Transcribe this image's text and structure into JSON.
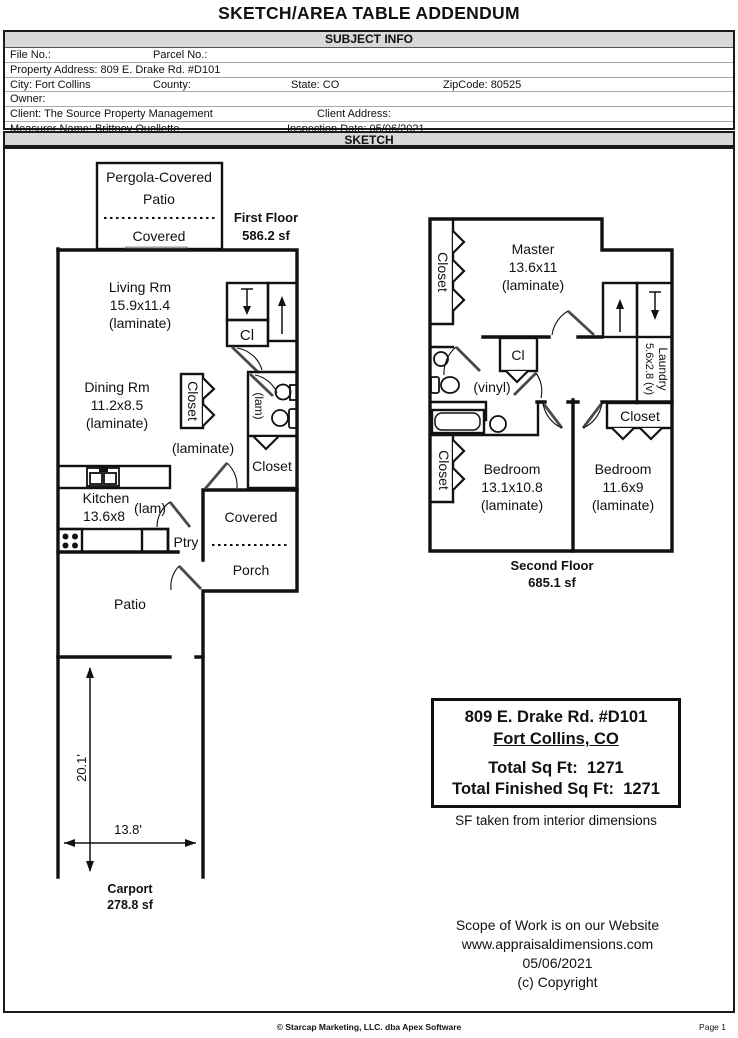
{
  "page": {
    "title": "SKETCH/AREA TABLE ADDENDUM",
    "footer_center": "© Starcap Marketing, LLC. dba Apex Software",
    "footer_right": "Page 1"
  },
  "colors": {
    "bar_gray": "#d8d8d8",
    "wall_black": "#111111"
  },
  "subject_info": {
    "section_title": "SUBJECT INFO",
    "file_no": "File No.:",
    "parcel_no": "Parcel No.:",
    "property_address": "Property Address: 809 E. Drake Rd. #D101",
    "city": "City: Fort Collins",
    "county": "County:",
    "state": "State: CO",
    "zipcode": "ZipCode: 80525",
    "owner": "Owner:",
    "client": "Client: The Source Property Management",
    "client_address": "Client Address:",
    "measurer": "Measurer Name: Brittney Ouellette",
    "inspection_date": "Inspection Date: 05/06/2021"
  },
  "sketch": {
    "section_title": "SKETCH",
    "first_floor": {
      "title": "First Floor",
      "area": "586.2 sf",
      "pergola": [
        "Pergola-Covered",
        "Patio",
        "Covered"
      ],
      "living": [
        "Living Rm",
        "15.9x11.4",
        "(laminate)"
      ],
      "dining": [
        "Dining Rm",
        "11.2x8.5",
        "(laminate)"
      ],
      "closet_center": "Closet",
      "hall_floor": "(laminate)",
      "bath_floor": "(lam)",
      "closet_lower": "Closet",
      "stair_closet": "Cl",
      "kitchen": [
        "Kitchen",
        "13.6x8"
      ],
      "kitchen_floor": "(lam)",
      "pantry": "Ptry",
      "porch": [
        "Covered",
        "Porch"
      ],
      "patio": "Patio",
      "carport": "Carport",
      "carport_area": "278.8 sf",
      "dim_vertical": "20.1'",
      "dim_horizontal": "13.8'"
    },
    "second_floor": {
      "title": "Second Floor",
      "area": "685.1 sf",
      "master": [
        "Master",
        "13.6x11",
        "(laminate)"
      ],
      "closet_upper": "Closet",
      "closet_lower": "Closet",
      "closet_right": "Closet",
      "stair_closet": "Cl",
      "bath_floor": "(vinyl)",
      "laundry": [
        "Laundry",
        "5.6x2.8 (v)"
      ],
      "bedroom1": [
        "Bedroom",
        "13.1x10.8",
        "(laminate)"
      ],
      "bedroom2": [
        "Bedroom",
        "11.6x9",
        "(laminate)"
      ]
    },
    "summary_box": {
      "address_line1": "809 E. Drake Rd. #D101",
      "address_line2": "Fort Collins, CO",
      "total_sqft": "Total Sq Ft:  1271",
      "total_finished": "Total Finished Sq Ft:  1271"
    },
    "sf_note": "SF taken from interior dimensions",
    "scope": [
      "Scope of Work is on our Website",
      "www.appraisaldimensions.com",
      "05/06/2021",
      "(c) Copyright"
    ]
  }
}
